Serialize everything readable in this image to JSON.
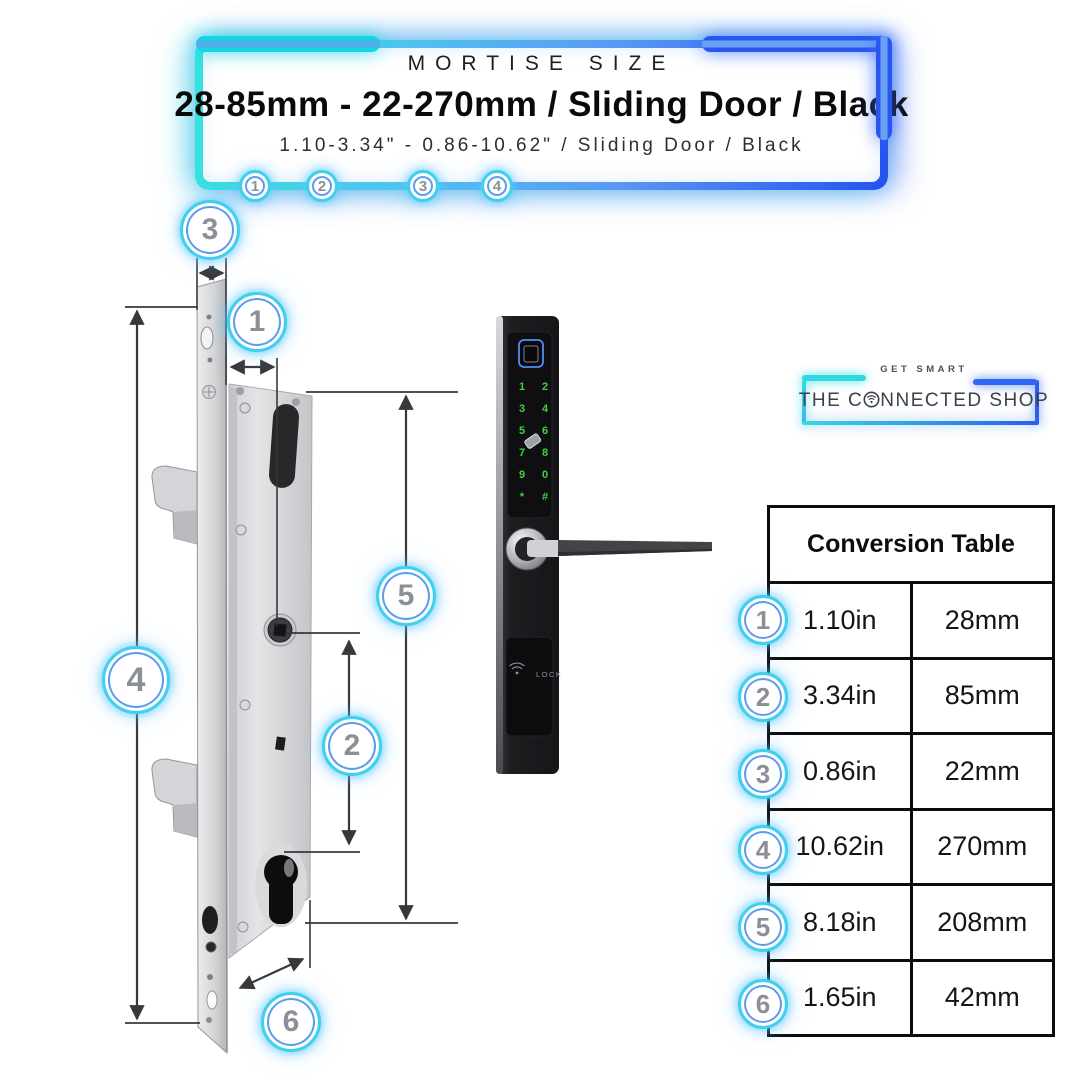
{
  "banner": {
    "title": "MORTISE SIZE",
    "heading": "28-85mm - 22-270mm / Sliding Door / Black",
    "subtitle": "1.10-3.34\" - 0.86-10.62\" / Sliding Door / Black",
    "callouts": [
      "1",
      "2",
      "3",
      "4"
    ]
  },
  "logo": {
    "tagline": "GET SMART",
    "brand_start": "THE C",
    "brand_end": "NNECTED SHOP"
  },
  "conversion_table": {
    "title": "Conversion Table",
    "rows": [
      {
        "num": "1",
        "inches": "1.10in",
        "mm": "28mm"
      },
      {
        "num": "2",
        "inches": "3.34in",
        "mm": "85mm"
      },
      {
        "num": "3",
        "inches": "0.86in",
        "mm": "22mm"
      },
      {
        "num": "4",
        "inches": "10.62in",
        "mm": "270mm"
      },
      {
        "num": "5",
        "inches": "8.18in",
        "mm": "208mm"
      },
      {
        "num": "6",
        "inches": "1.65in",
        "mm": "42mm"
      }
    ]
  },
  "diagram": {
    "callouts": {
      "c1": "1",
      "c2": "2",
      "c3": "3",
      "c4": "4",
      "c5": "5",
      "c6": "6"
    }
  },
  "lock": {
    "keypad": [
      [
        "1",
        "2"
      ],
      [
        "3",
        "4"
      ],
      [
        "5",
        "6"
      ],
      [
        "7",
        "8"
      ],
      [
        "9",
        "0"
      ],
      [
        "*",
        "#"
      ]
    ],
    "panel_label": "LOCK"
  },
  "colors": {
    "accent_cyan": "#2fd9e2",
    "accent_blue": "#2b5cf2",
    "digit_green": "#3ed13e",
    "sensor_blue": "#4f8ef7"
  }
}
